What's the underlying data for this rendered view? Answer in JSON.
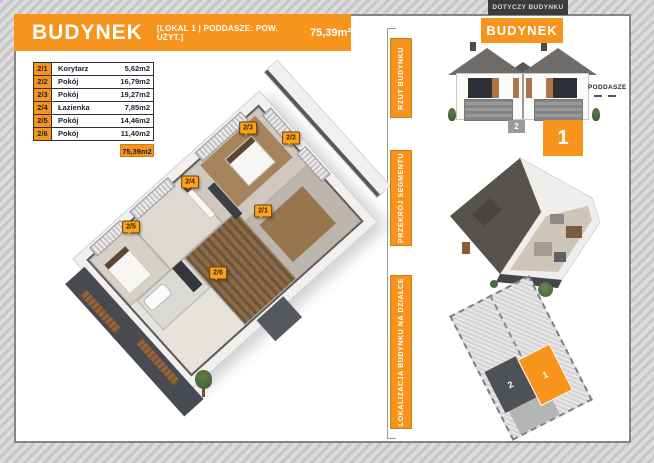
{
  "header": {
    "title": "BUDYNEK",
    "subtitle": "[LOKAL 1 | PODDASZE: POW. UŻYT.]",
    "area": "75,39m²"
  },
  "rooms": {
    "rows": [
      {
        "no": "2/1",
        "name": "Korytarz",
        "area": "5,62m2"
      },
      {
        "no": "2/2",
        "name": "Pokój",
        "area": "16,79m2"
      },
      {
        "no": "2/3",
        "name": "Pokój",
        "area": "19,27m2"
      },
      {
        "no": "2/4",
        "name": "Łazienka",
        "area": "7,85m2"
      },
      {
        "no": "2/5",
        "name": "Pokój",
        "area": "14,46m2"
      },
      {
        "no": "2/6",
        "name": "Pokój",
        "area": "11,40m2"
      }
    ],
    "total": "75,39m2"
  },
  "panel": {
    "applies": "DOTYCZY BUDYNKU",
    "building": "BUDYNEK",
    "sections": [
      {
        "label": "RZUT BUDYNKU"
      },
      {
        "label": "PRZEKRÓJ SEGMENTU"
      },
      {
        "label": "LOKALIZACJA BUDYNKU NA DZIAŁCE"
      }
    ],
    "attic_label": "PODDASZE",
    "segment_current": "1",
    "segment_other": "2"
  },
  "colors": {
    "accent": "#F7941E",
    "banner_dark": "#3B3B3B"
  }
}
